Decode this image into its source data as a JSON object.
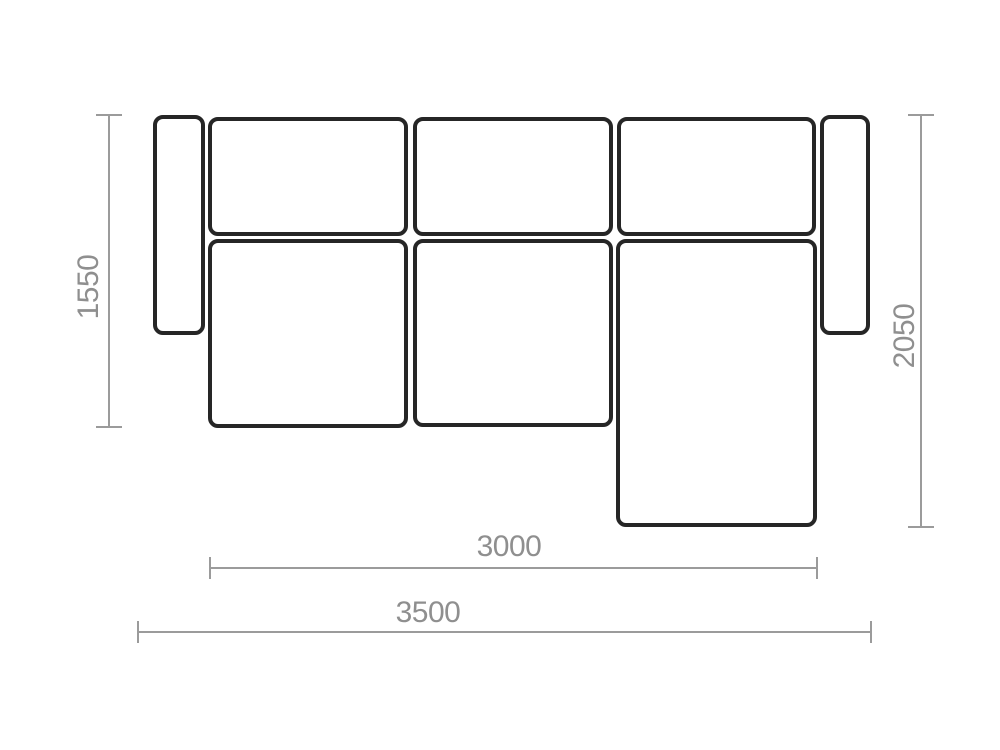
{
  "diagram": {
    "type": "sofa-sectional-floor-plan",
    "dimensions": {
      "left": {
        "value": "1550",
        "orientation": "vertical",
        "side": "left"
      },
      "right": {
        "value": "2050",
        "orientation": "vertical",
        "side": "right"
      },
      "inner_width": {
        "value": "3000",
        "orientation": "horizontal",
        "side": "bottom"
      },
      "outer_width": {
        "value": "3500",
        "orientation": "horizontal",
        "side": "bottom"
      }
    },
    "parts": [
      {
        "name": "left-armrest"
      },
      {
        "name": "back-cushion-1"
      },
      {
        "name": "back-cushion-2"
      },
      {
        "name": "back-cushion-3"
      },
      {
        "name": "seat-cushion-1"
      },
      {
        "name": "seat-cushion-2"
      },
      {
        "name": "chaise-lounge"
      },
      {
        "name": "right-armrest"
      }
    ],
    "colors": {
      "outline": "#262626",
      "dimension_line": "#9b9b9b",
      "label_text": "#8f8f8f",
      "background": "#ffffff"
    }
  }
}
